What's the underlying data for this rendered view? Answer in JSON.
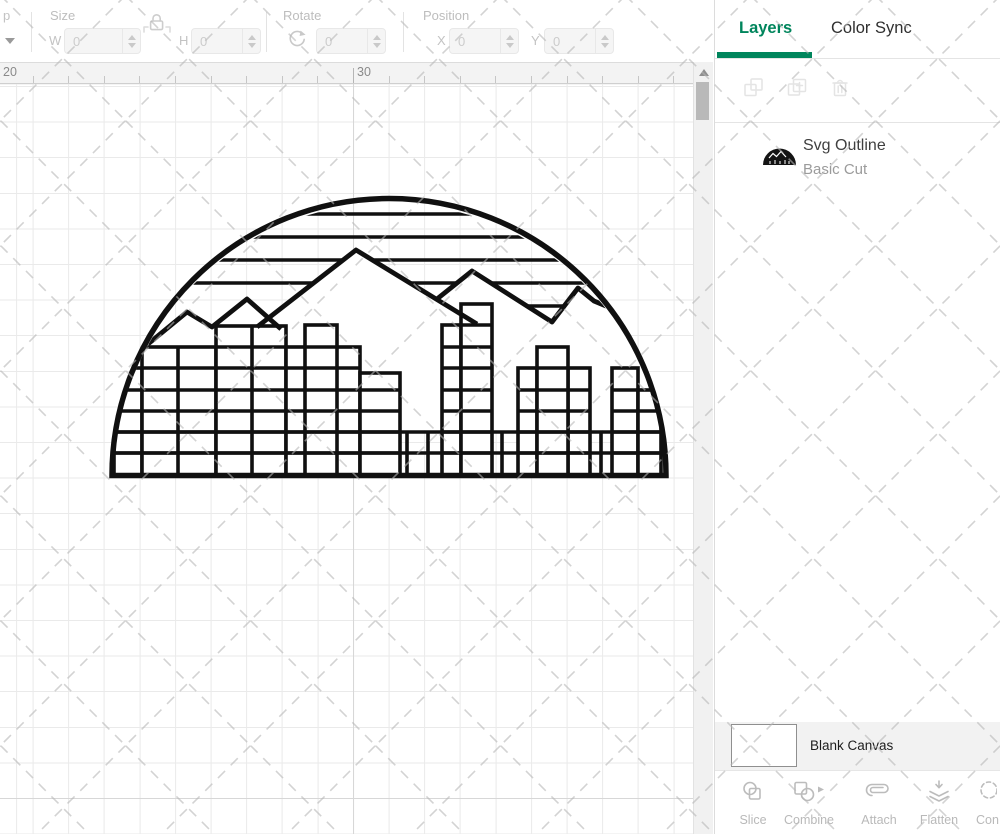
{
  "toolbar": {
    "flip_partial": "p",
    "size": {
      "label": "Size",
      "w_label": "W",
      "w_value": "0",
      "h_label": "H",
      "h_value": "0"
    },
    "rotate": {
      "label": "Rotate",
      "value": "0"
    },
    "position": {
      "label": "Position",
      "x_label": "X",
      "x_value": "0",
      "y_label": "Y",
      "y_value": "0"
    }
  },
  "ruler": {
    "start_label": "20",
    "mid_label": "30"
  },
  "panel": {
    "tab_layers": "Layers",
    "tab_color_sync": "Color Sync",
    "layer": {
      "title": "Svg Outline",
      "subtitle": "Basic Cut"
    },
    "canvas_row_label": "Blank Canvas",
    "actions": [
      "Slice",
      "Combine",
      "Attach",
      "Flatten",
      "Con"
    ]
  },
  "colors": {
    "accent_green": "#00855c",
    "artwork_stroke": "#101010",
    "disabled_icon": "#e4e4e4",
    "toolbar_text": "#bdbdbd",
    "grid_line": "#eaeaea"
  },
  "artwork": {
    "cx": 389,
    "cy": 476,
    "r": 277,
    "baseline": 475.5,
    "stroke_widths": {
      "stripe": 3.4,
      "building": 3.6,
      "mountain": 4.8,
      "outline": 5.5
    },
    "stripes": [
      214,
      237,
      260,
      283
    ],
    "stripe_extra": {
      "y": 306,
      "x1": 430,
      "x2": 668
    },
    "mountain_mask": [
      [
        148,
        344
      ],
      [
        187,
        312
      ],
      [
        212,
        327
      ],
      [
        247,
        299
      ],
      [
        269,
        318
      ],
      [
        356,
        250
      ],
      [
        437,
        299
      ],
      [
        472,
        271
      ],
      [
        552,
        322
      ],
      [
        578,
        288
      ],
      [
        594,
        301
      ],
      [
        616,
        310
      ],
      [
        650,
        365
      ],
      [
        656,
        430
      ],
      [
        126,
        430
      ],
      [
        140,
        352
      ]
    ],
    "mountain_lines": [
      [
        [
          148,
          344
        ],
        [
          187,
          312
        ],
        [
          212,
          327
        ],
        [
          247,
          299
        ],
        [
          281,
          329
        ]
      ],
      [
        [
          257,
          327
        ],
        [
          356,
          250
        ],
        [
          477,
          324
        ]
      ],
      [
        [
          437,
          299
        ],
        [
          472,
          271
        ],
        [
          552,
          322
        ],
        [
          578,
          288
        ],
        [
          594,
          301
        ],
        [
          618,
          311
        ]
      ]
    ],
    "window_rows": [
      304,
      325,
      347,
      368,
      390,
      411,
      432,
      453
    ],
    "band": {
      "rows": [
        432,
        453
      ],
      "dividers": [
        407,
        428,
        502,
        601
      ],
      "x1": 112,
      "x2": 667
    },
    "buildings": [
      {
        "x1": 114,
        "x2": 142,
        "top": 368,
        "divs": []
      },
      {
        "x1": 142,
        "x2": 216,
        "top": 347,
        "divs": [
          178
        ]
      },
      {
        "x1": 216,
        "x2": 286,
        "top": 326,
        "divs": [
          252
        ]
      },
      {
        "x1": 286,
        "x2": 360,
        "top": 347,
        "divs": []
      },
      {
        "x1": 305,
        "x2": 337,
        "top": 325,
        "divs": []
      },
      {
        "x1": 360,
        "x2": 400,
        "top": 373,
        "divs": []
      },
      {
        "x1": 442,
        "x2": 461,
        "top": 325,
        "divs": []
      },
      {
        "x1": 461,
        "x2": 492,
        "top": 304,
        "divs": []
      },
      {
        "x1": 518,
        "x2": 590,
        "top": 368,
        "divs": [
          537,
          568
        ]
      },
      {
        "x1": 537,
        "x2": 568,
        "top": 347,
        "divs": []
      },
      {
        "x1": 612,
        "x2": 638,
        "top": 368,
        "divs": []
      },
      {
        "x1": 638,
        "x2": 661,
        "top": 390,
        "divs": []
      }
    ]
  }
}
